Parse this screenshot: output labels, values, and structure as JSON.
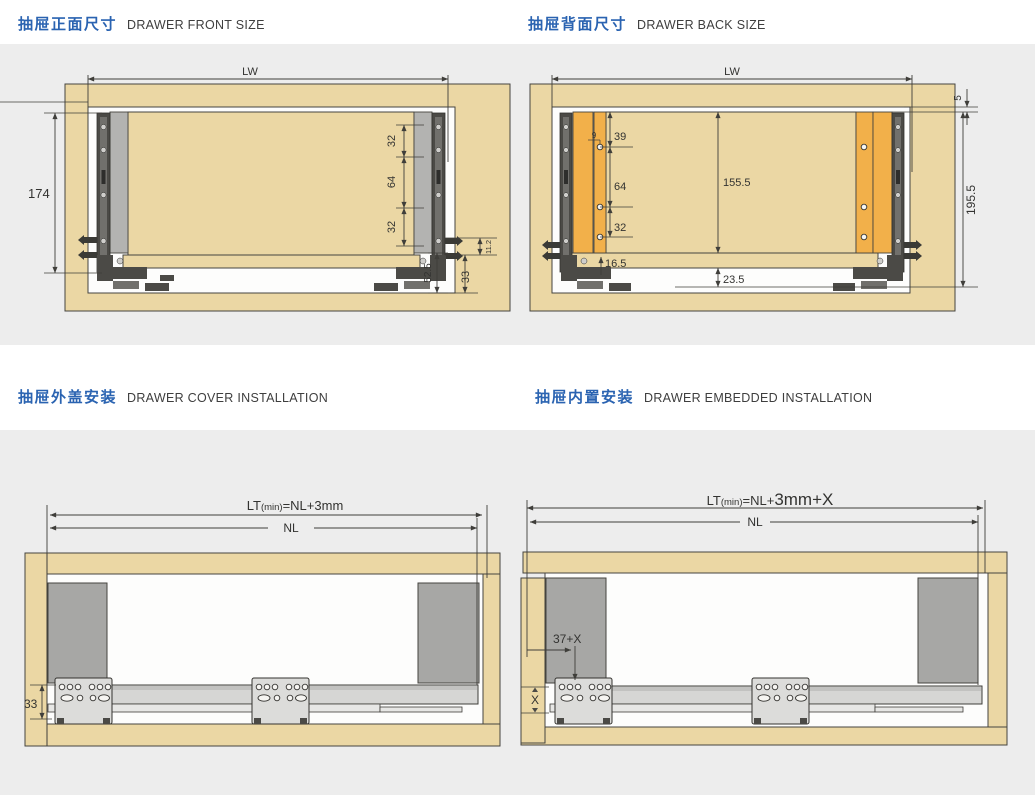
{
  "colors": {
    "accent": "#2a63b1",
    "wood": "#ebd7a4",
    "orange": "#f2b04a",
    "panel": "#ededed"
  },
  "titles": {
    "front": {
      "zh": "抽屉正面尺寸",
      "en": "DRAWER FRONT SIZE"
    },
    "back": {
      "zh": "抽屉背面尺寸",
      "en": "DRAWER BACK SIZE"
    },
    "cover": {
      "zh": "抽屉外盖安装",
      "en": "DRAWER COVER INSTALLATION"
    },
    "embedded": {
      "zh": "抽屉内置安装",
      "en": "DRAWER EMBEDDED INSTALLATION"
    }
  },
  "d1": {
    "lw": "LW",
    "height": "174",
    "pitch_top": "32",
    "pitch_mid": "64",
    "pitch_bot": "32",
    "bottom": "52.5",
    "lip": "11.2",
    "rail": "33"
  },
  "d2": {
    "lw": "LW",
    "gap_top": "5",
    "total": "195.5",
    "hole_off": "9",
    "p39": "39",
    "p64": "64",
    "p32": "32",
    "back_h": "155.5",
    "inset": "16.5",
    "clear": "23.5"
  },
  "d3": {
    "lt_pre": "LT",
    "lt_min": "(min)",
    "lt_rest": "=NL+3mm",
    "nl": "NL",
    "rail": "33"
  },
  "d4": {
    "lt_pre": "LT",
    "lt_min": "(min)",
    "lt_mid": "=NL+",
    "lt_big": "3mm+X",
    "nl": "NL",
    "front_off": "37+X",
    "gap": "X"
  }
}
